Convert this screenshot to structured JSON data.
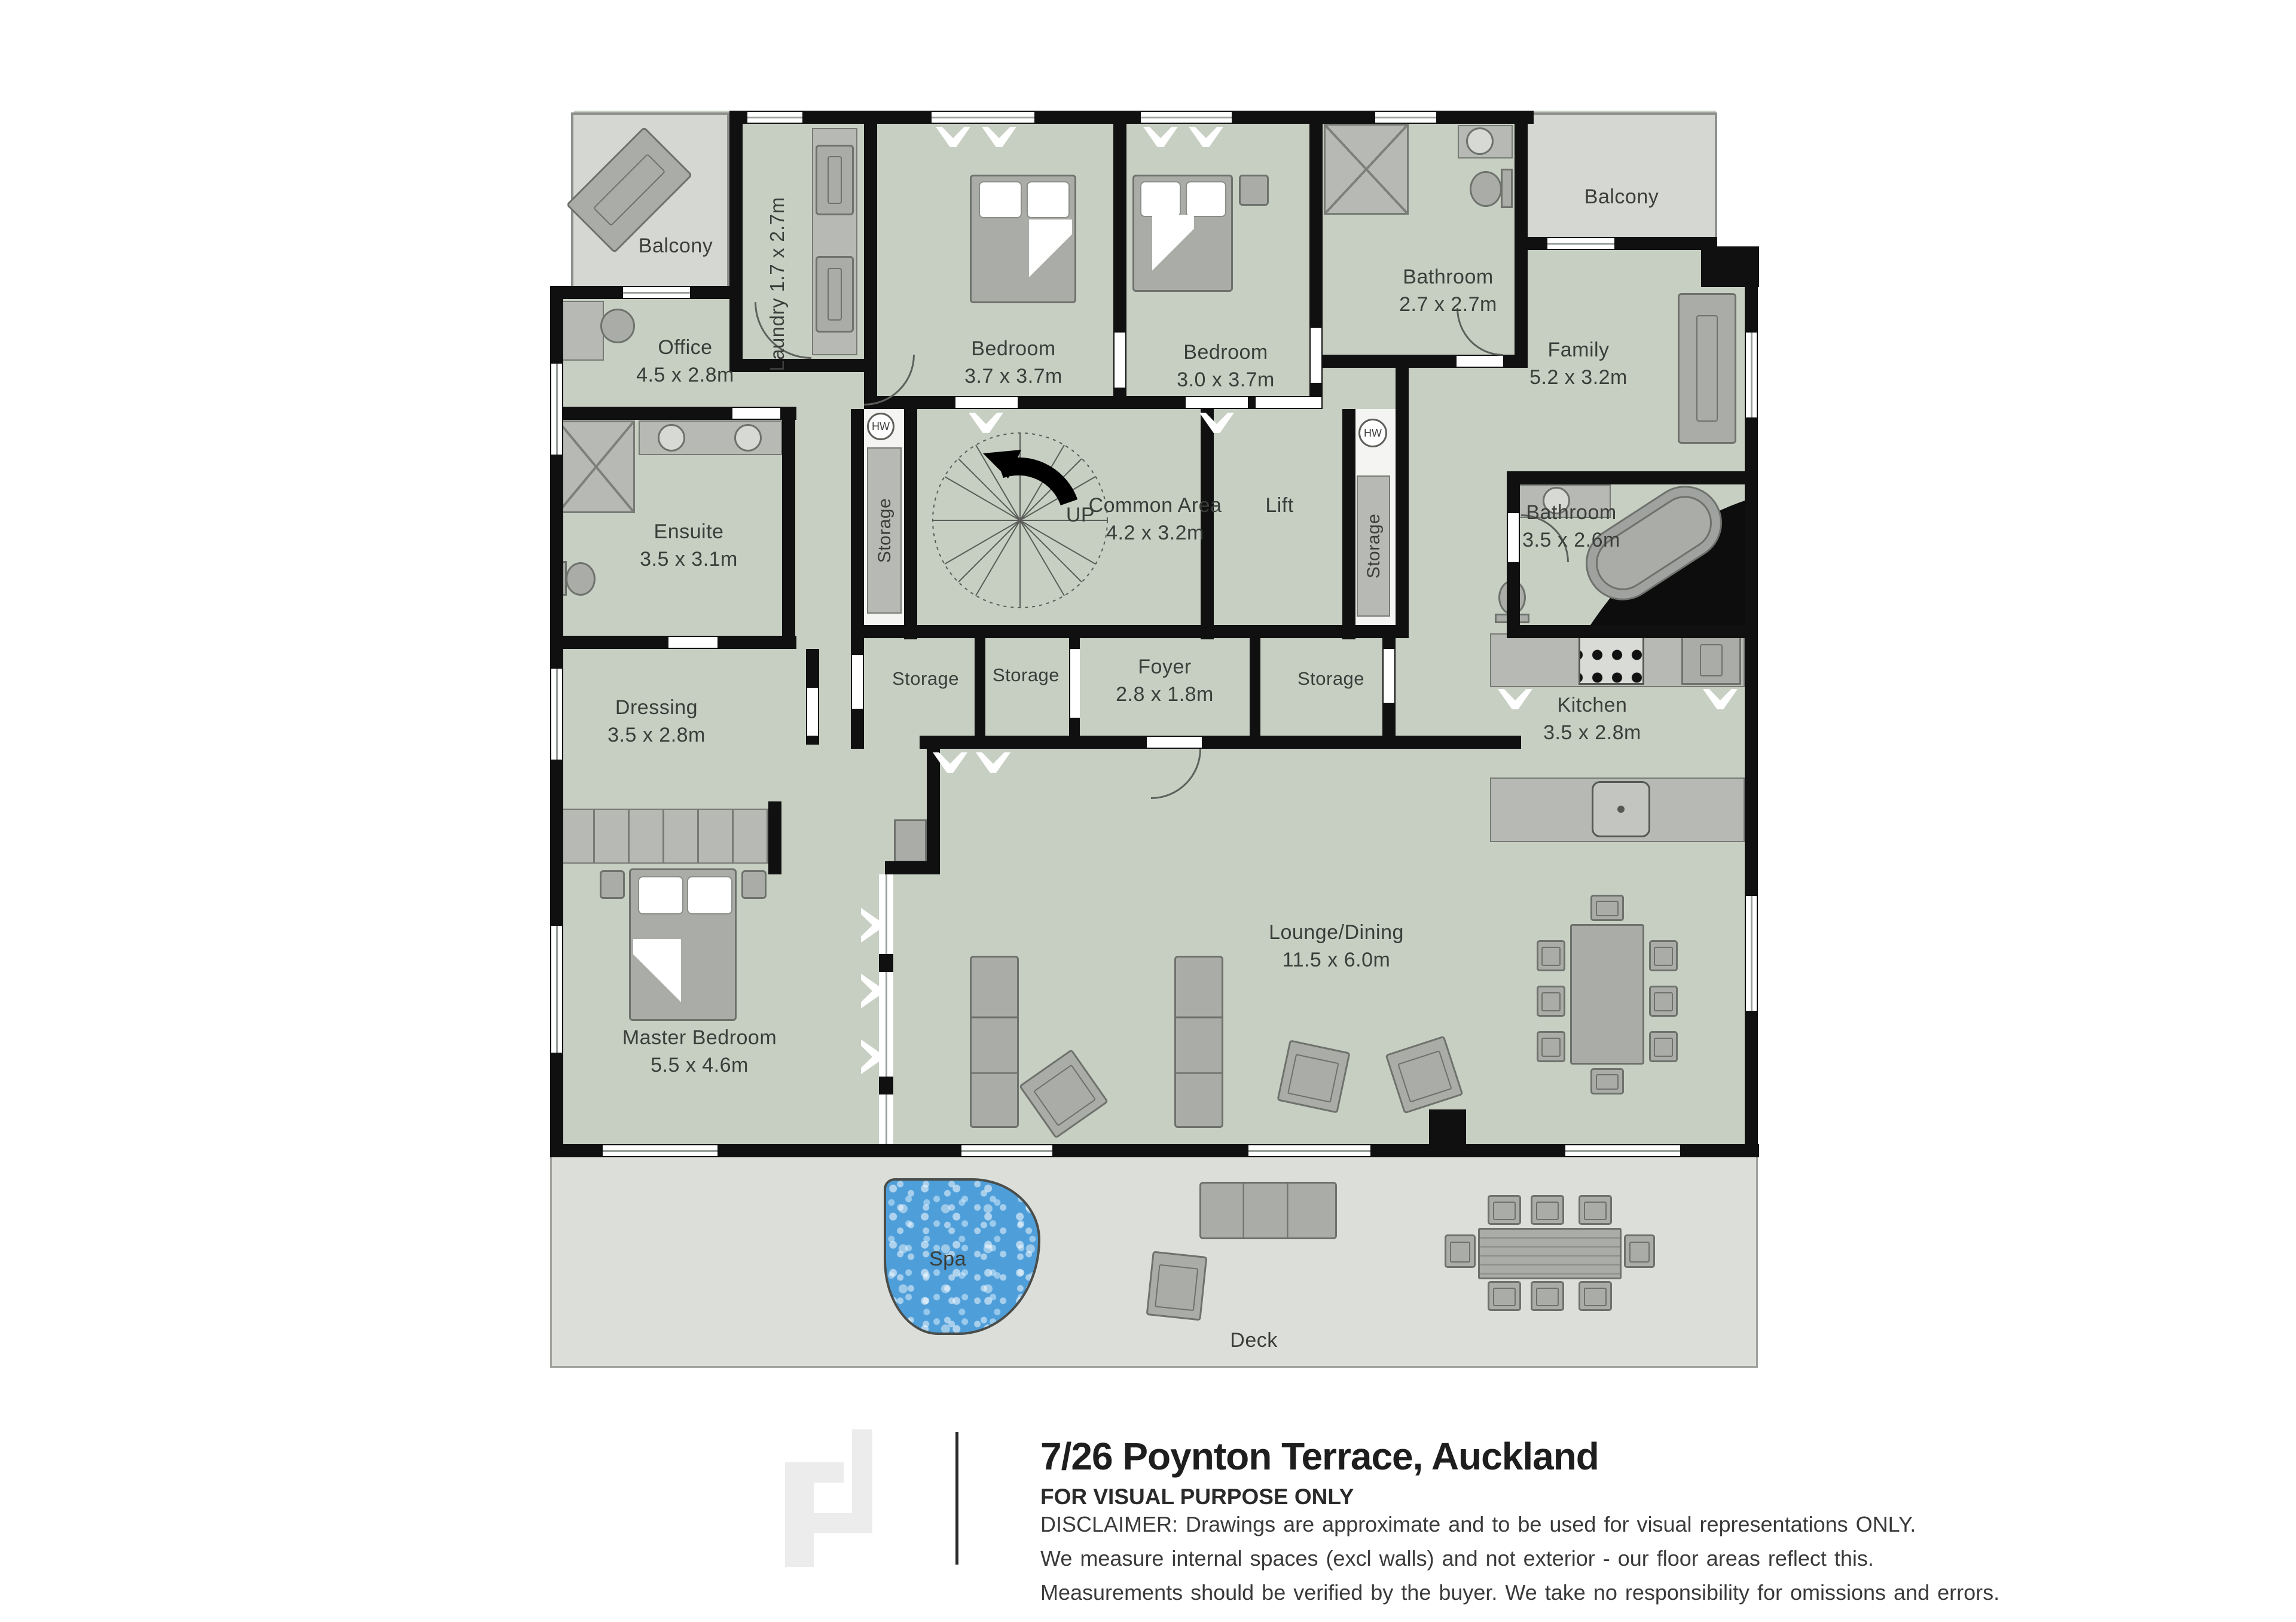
{
  "document": {
    "title": "7/26 Poynton Terrace, Auckland",
    "subtitle": "FOR VISUAL PURPOSE ONLY",
    "disclaimer": [
      "DISCLAIMER:  Drawings are approximate and to be used for visual representations ONLY.",
      "We measure internal spaces (excl walls) and not exterior - our floor areas reflect this.",
      "Measurements should be verified by the buyer. We take no responsibility for omissions and errors."
    ]
  },
  "floorplan": {
    "rooms": {
      "balcony_tl": {
        "name": "Balcony"
      },
      "balcony_tr": {
        "name": "Balcony"
      },
      "laundry": {
        "name": "Laundry",
        "dims": "1.7 x 2.7m"
      },
      "bedroom1": {
        "name": "Bedroom",
        "dims": "3.7 x 3.7m"
      },
      "bedroom2": {
        "name": "Bedroom",
        "dims": "3.0 x 3.7m"
      },
      "bathroom_top": {
        "name": "Bathroom",
        "dims": "2.7 x 2.7m"
      },
      "family": {
        "name": "Family",
        "dims": "5.2 x 3.2m"
      },
      "office": {
        "name": "Office",
        "dims": "4.5 x 2.8m"
      },
      "common": {
        "name": "Common Area",
        "dims": "4.2 x 3.2m"
      },
      "lift": {
        "name": "Lift"
      },
      "ensuite": {
        "name": "Ensuite",
        "dims": "3.5 x 3.1m"
      },
      "bathroom_right": {
        "name": "Bathroom",
        "dims": "3.5 x 2.6m"
      },
      "storage_strip_left": {
        "name": "Storage"
      },
      "storage_strip_right": {
        "name": "Storage"
      },
      "storage_a": {
        "name": "Storage"
      },
      "storage_b": {
        "name": "Storage"
      },
      "foyer": {
        "name": "Foyer",
        "dims": "2.8 x 1.8m"
      },
      "storage_c": {
        "name": "Storage"
      },
      "dressing": {
        "name": "Dressing",
        "dims": "3.5 x 2.8m"
      },
      "kitchen": {
        "name": "Kitchen",
        "dims": "3.5 x 2.8m"
      },
      "master": {
        "name": "Master Bedroom",
        "dims": "5.5 x 4.6m"
      },
      "lounge": {
        "name": "Lounge/Dining",
        "dims": "11.5 x 6.0m"
      },
      "deck": {
        "name": "Deck"
      },
      "spa": {
        "name": "Spa"
      }
    },
    "markers": {
      "up": "UP",
      "hot_water": "HW"
    },
    "icons": {
      "spiral-staircase-icon": "circle with radial treads and black up-arrow",
      "spa-icon": "blue water blob",
      "hot-water-cylinder-icon": "circle labelled HW"
    }
  },
  "colors": {
    "sage": "#c6cfc2",
    "balcony": "#d4d7d2",
    "deck": "#dcdeda",
    "wall": "#101010",
    "furn": "#a9aca7",
    "furndark": "#6e716c",
    "counter": "#b6b9b4",
    "water": "#4e9ed9",
    "text": "#3b3e3a",
    "outline": "#8d908c"
  }
}
